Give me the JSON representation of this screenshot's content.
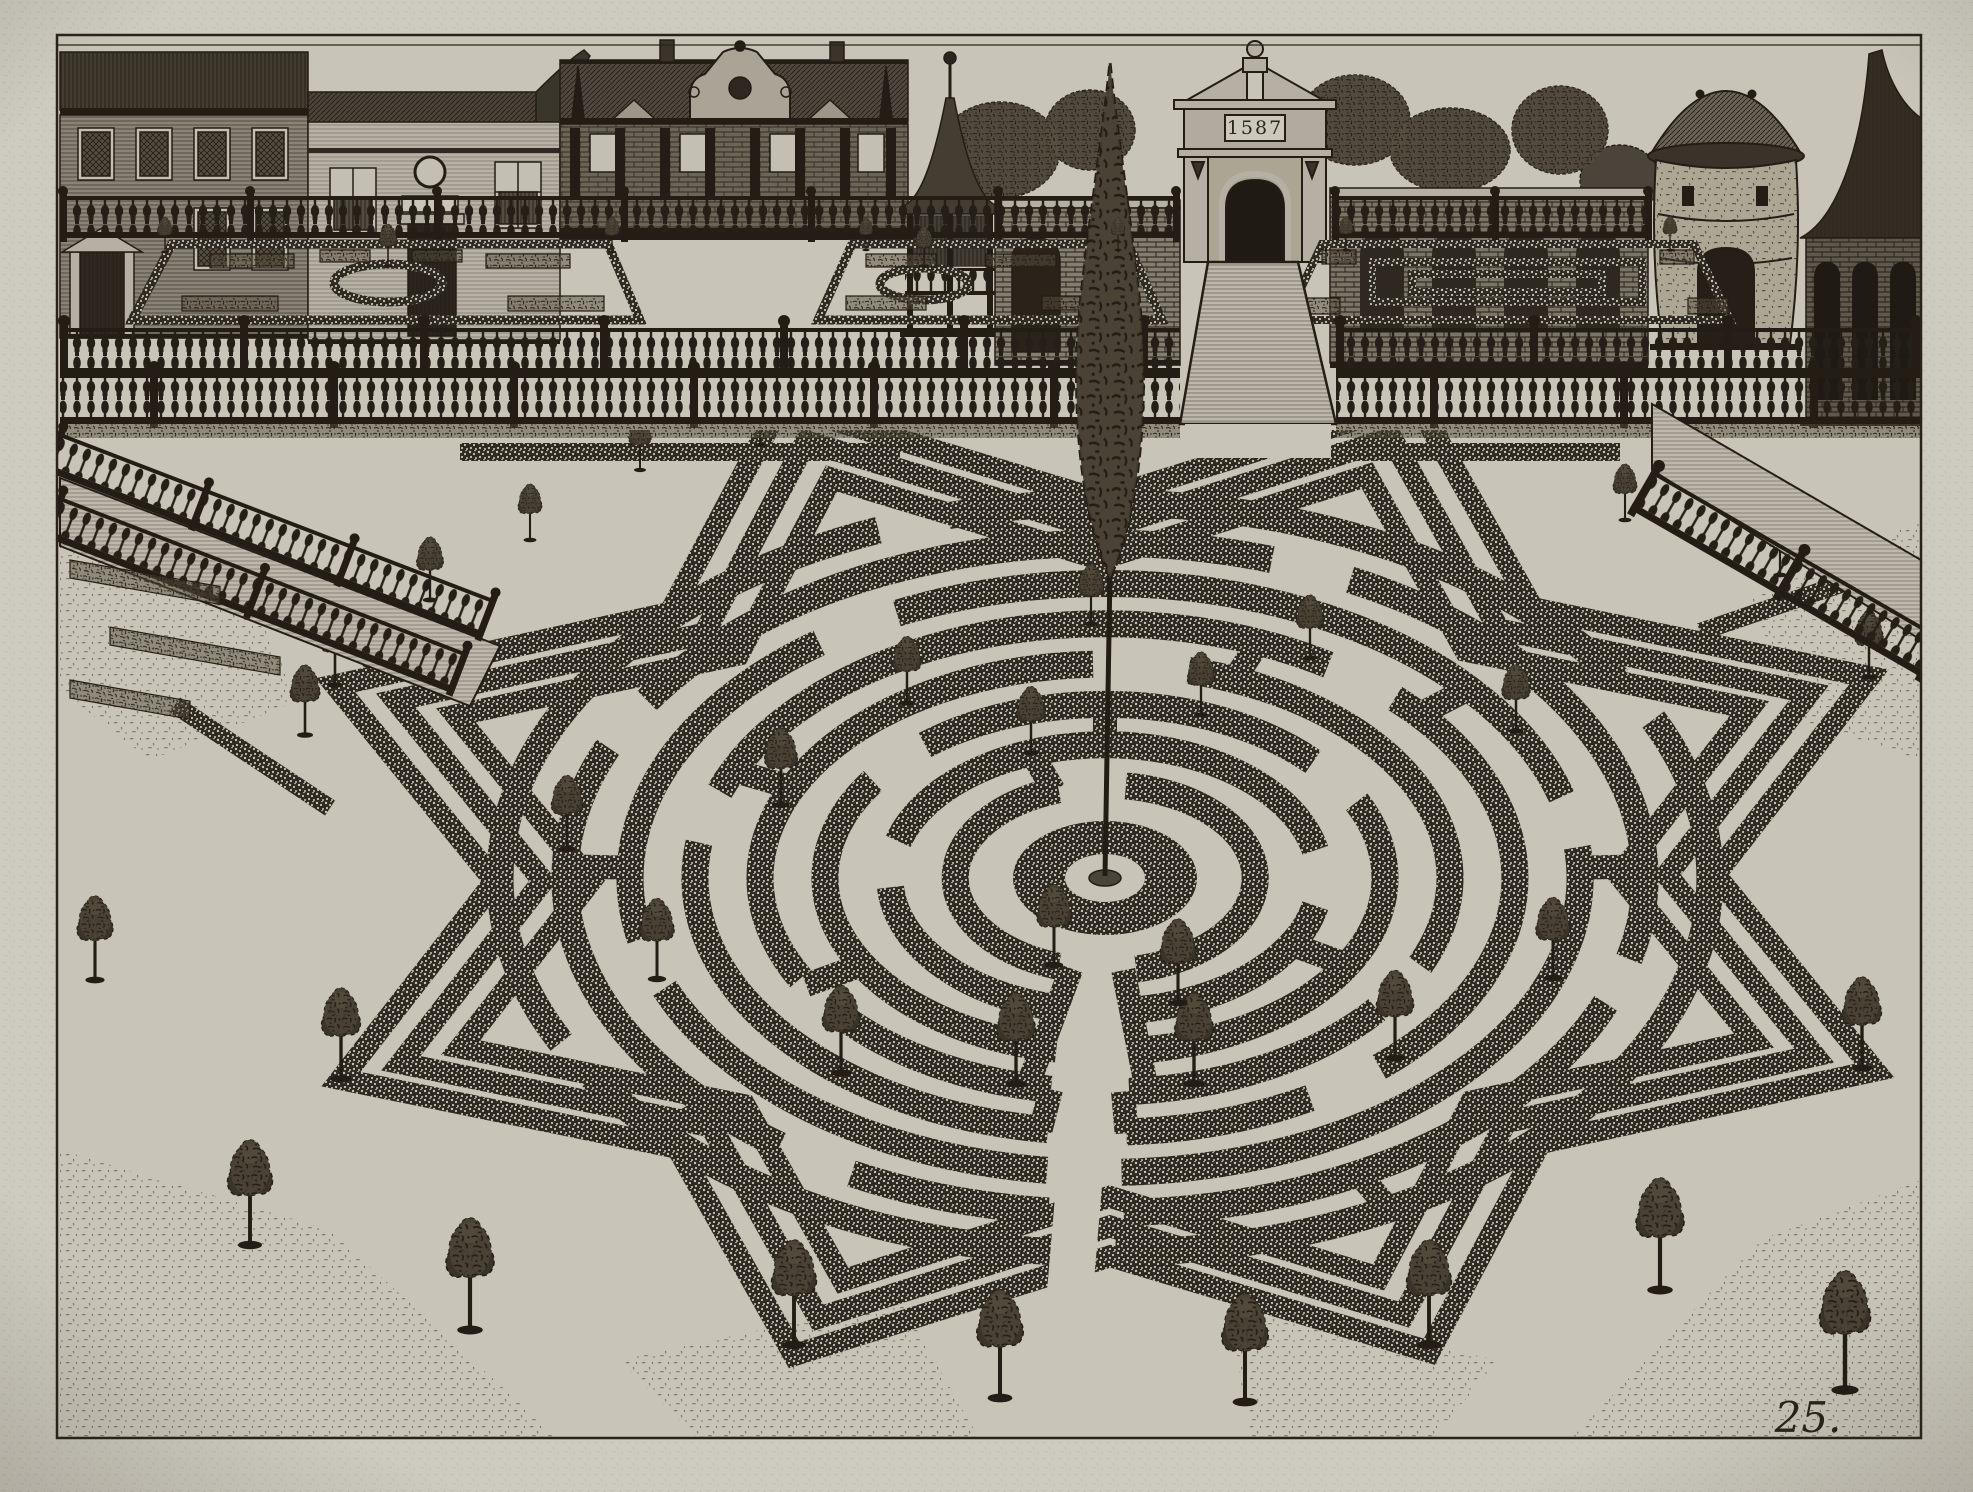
{
  "artwork": {
    "plate_number": "25.",
    "gate_plaque_date": "1587",
    "subject": "garden-labyrinth-engraving"
  },
  "palette": {
    "paper_margin": "#cdcabf",
    "plate_bg": "#c8c5b8",
    "ink": "#241d15",
    "hedge_dark": "#2f2a21",
    "hedge_base": "#4b443a",
    "stone_light": "#b5b0a3",
    "walk_light": "#bdb8ab"
  },
  "maze": {
    "cx": 1105,
    "cy": 878,
    "squash": 0.62,
    "ring_width": 27,
    "rings": [
      {
        "r": 150,
        "gaps": [
          [
            78,
            108
          ],
          [
            252,
            278
          ]
        ]
      },
      {
        "r": 215,
        "gaps": [
          [
            80,
            104
          ],
          [
            348,
            12
          ],
          [
            176,
            196
          ]
        ]
      },
      {
        "r": 280,
        "gaps": [
          [
            84,
            100
          ],
          [
            214,
            230
          ],
          [
            318,
            334
          ]
        ]
      },
      {
        "r": 345,
        "gaps": [
          [
            86,
            99
          ],
          [
            138,
            152
          ],
          [
            268,
            284
          ],
          [
            24,
            38
          ]
        ]
      },
      {
        "r": 410,
        "gaps": [
          [
            87,
            98
          ],
          [
            188,
            200
          ],
          [
            303,
            315
          ],
          [
            48,
            60
          ]
        ]
      },
      {
        "r": 475,
        "gaps": [
          [
            88,
            97
          ],
          [
            158,
            168
          ],
          [
            233,
            244
          ],
          [
            344,
            354
          ]
        ]
      },
      {
        "r": 540,
        "gaps": [
          [
            88,
            96
          ],
          [
            118,
            127
          ],
          [
            203,
            212
          ],
          [
            288,
            297
          ],
          [
            14,
            22
          ]
        ]
      },
      {
        "r": 605,
        "gaps": [
          [
            89,
            95
          ],
          [
            148,
            154
          ],
          [
            248,
            255
          ],
          [
            328,
            335
          ]
        ]
      }
    ],
    "spokes": [
      {
        "a": 83,
        "r1": 150,
        "r2": 345
      },
      {
        "a": 103,
        "r1": 150,
        "r2": 345
      },
      {
        "a": 87,
        "r1": 345,
        "r2": 412
      },
      {
        "a": 99,
        "r1": 345,
        "r2": 412
      },
      {
        "a": 30,
        "r1": 215,
        "r2": 280
      },
      {
        "a": 150,
        "r1": 280,
        "r2": 345
      },
      {
        "a": 205,
        "r1": 345,
        "r2": 410
      },
      {
        "a": 250,
        "r1": 150,
        "r2": 215
      },
      {
        "a": 320,
        "r1": 410,
        "r2": 475
      },
      {
        "a": 358,
        "r1": 475,
        "r2": 540
      },
      {
        "a": 182,
        "r1": 475,
        "r2": 540
      },
      {
        "a": 62,
        "r1": 540,
        "r2": 605
      },
      {
        "a": 137,
        "r1": 540,
        "r2": 605
      },
      {
        "a": 270,
        "r1": 215,
        "r2": 280
      },
      {
        "a": 292,
        "r1": 345,
        "r2": 410
      }
    ],
    "corridor": {
      "angle": 93,
      "r1": 24,
      "r2": 880,
      "width": 46
    },
    "center": {
      "outer_rx": 92,
      "outer_ry": 57,
      "inner_rx": 40,
      "inner_ry": 24,
      "mound_rx": 16,
      "mound_ry": 8
    },
    "star": {
      "tip_r": [
        830,
        765,
        700
      ],
      "valley_r": [
        610,
        562,
        514
      ],
      "point_angles": [
        22,
        67,
        112,
        157,
        202,
        247,
        292,
        337
      ],
      "width": 22
    }
  },
  "hedge_strips": [
    [
      [
        460,
        452
      ],
      [
        900,
        452
      ]
    ],
    [
      [
        1336,
        452
      ],
      [
        1620,
        452
      ]
    ],
    [
      [
        205,
        565
      ],
      [
        420,
        668
      ]
    ],
    [
      [
        175,
        705
      ],
      [
        330,
        808
      ]
    ],
    [
      [
        1700,
        632
      ],
      [
        1888,
        568
      ]
    ]
  ],
  "ground_patches": [
    [
      [
        60,
        1150
      ],
      [
        330,
        1230
      ],
      [
        560,
        1440
      ],
      [
        60,
        1440
      ]
    ],
    [
      [
        1570,
        1440
      ],
      [
        1760,
        1240
      ],
      [
        1921,
        1180
      ],
      [
        1921,
        1440
      ]
    ],
    [
      [
        60,
        520
      ],
      [
        230,
        560
      ],
      [
        300,
        700
      ],
      [
        150,
        760
      ],
      [
        60,
        690
      ]
    ],
    [
      [
        1921,
        520
      ],
      [
        1750,
        600
      ],
      [
        1800,
        720
      ],
      [
        1921,
        760
      ]
    ],
    [
      [
        620,
        1360
      ],
      [
        900,
        1300
      ],
      [
        980,
        1440
      ],
      [
        700,
        1440
      ]
    ],
    [
      [
        1230,
        1310
      ],
      [
        1500,
        1360
      ],
      [
        1430,
        1440
      ],
      [
        1250,
        1440
      ]
    ]
  ],
  "trees_maze": [
    [
      781,
      805,
      1.1
    ],
    [
      907,
      703,
      0.95
    ],
    [
      1091,
      624,
      0.85
    ],
    [
      1310,
      658,
      0.9
    ],
    [
      1516,
      731,
      0.95
    ],
    [
      1553,
      978,
      1.15
    ],
    [
      1395,
      1058,
      1.25
    ],
    [
      1194,
      1084,
      1.3
    ],
    [
      1016,
      1084,
      1.3
    ],
    [
      841,
      1073,
      1.25
    ],
    [
      657,
      979,
      1.15
    ],
    [
      567,
      849,
      1.05
    ],
    [
      1031,
      753,
      0.95
    ],
    [
      1201,
      715,
      0.9
    ],
    [
      1178,
      1003,
      1.2
    ],
    [
      1054,
      965,
      1.15
    ],
    [
      794,
      1345,
      1.5
    ],
    [
      341,
      1079,
      1.3
    ],
    [
      335,
      685,
      1.0
    ],
    [
      1429,
      1345,
      1.5
    ],
    [
      1869,
      677,
      0.95
    ],
    [
      1862,
      1068,
      1.3
    ],
    [
      430,
      600,
      0.9
    ],
    [
      370,
      665,
      0.95
    ],
    [
      305,
      735,
      1.0
    ],
    [
      250,
      1245,
      1.5
    ],
    [
      470,
      1330,
      1.6
    ],
    [
      1660,
      1290,
      1.6
    ],
    [
      1845,
      1390,
      1.7
    ],
    [
      95,
      980,
      1.2
    ],
    [
      530,
      540,
      0.8
    ],
    [
      640,
      470,
      0.75
    ],
    [
      760,
      445,
      0.7
    ],
    [
      1625,
      520,
      0.8
    ],
    [
      1780,
      575,
      0.85
    ],
    [
      1000,
      1398,
      1.55
    ],
    [
      1245,
      1402,
      1.55
    ]
  ],
  "trees_terrace": [
    [
      388,
      266,
      0.6
    ],
    [
      165,
      252,
      0.5
    ],
    [
      612,
      252,
      0.5
    ],
    [
      924,
      266,
      0.56
    ],
    [
      866,
      250,
      0.46
    ],
    [
      1118,
      250,
      0.46
    ],
    [
      1346,
      250,
      0.48
    ],
    [
      1670,
      250,
      0.48
    ]
  ]
}
